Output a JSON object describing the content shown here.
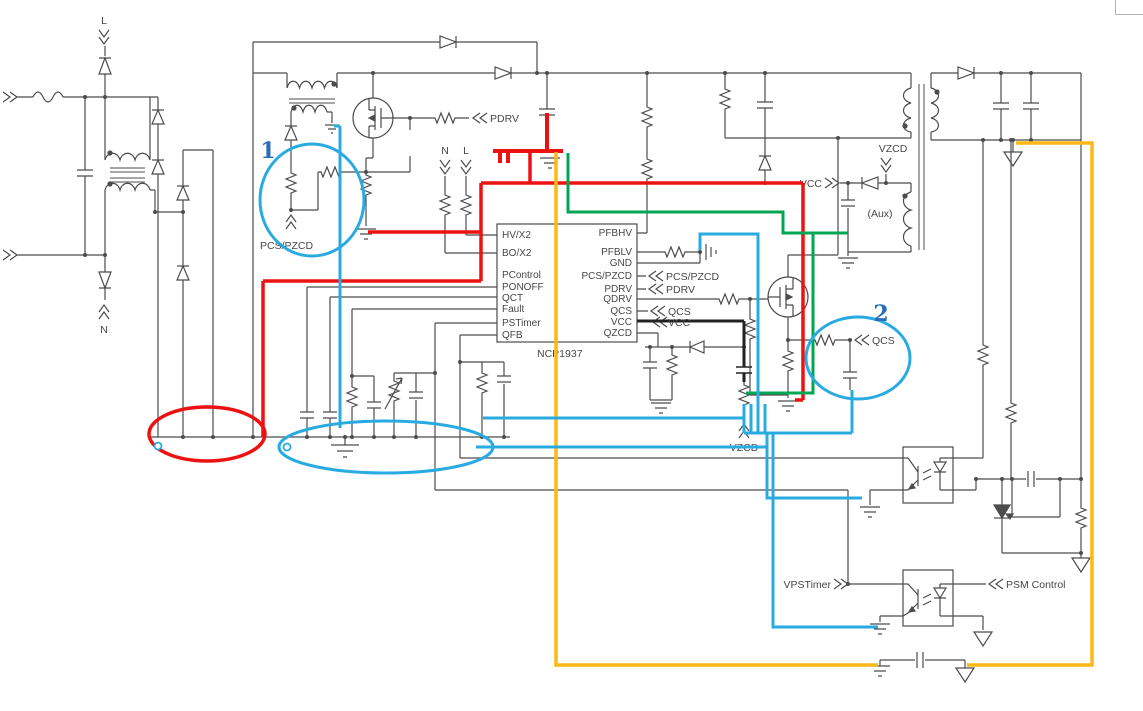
{
  "ic": {
    "part_number": "NCP1937",
    "left_pins": [
      "HV/X2",
      "BO/X2",
      "PControl",
      "PONOFF",
      "QCT",
      "Fault",
      "PSTimer",
      "QFB"
    ],
    "right_pins": [
      "PFBHV",
      "PFBLV",
      "GND",
      "PCS/PZCD",
      "PDRV",
      "QDRV",
      "QCS",
      "VCC",
      "QZCD"
    ]
  },
  "labels": {
    "mains_line": "L",
    "mains_neutral": "N",
    "sense_n": "N",
    "sense_l": "L",
    "pfc_drive": "PDRV",
    "pfc_current_sense": "PCS/PZCD",
    "conn_pcs_pzcd": "PCS/PZCD",
    "conn_pdrv": "PDRV",
    "conn_qcs": "QCS",
    "conn_vcc": "VCC",
    "vcc_supply": "VCC",
    "vzcd_aux": "VZCD",
    "aux_winding": "(Aux)",
    "qcs_sense": "QCS",
    "vzcd_divider": "VZCD",
    "vpstimer": "VPSTimer",
    "psm_control": "PSM Control"
  },
  "annotations": {
    "marker_1": "1",
    "marker_2": "2"
  },
  "colors": {
    "wire": "#4c4c4c",
    "highlight_red": "#ee1111",
    "highlight_blue": "#29abe2",
    "highlight_green": "#00a651",
    "highlight_orange": "#fcb813",
    "marker_text": "#2a6cb8"
  }
}
